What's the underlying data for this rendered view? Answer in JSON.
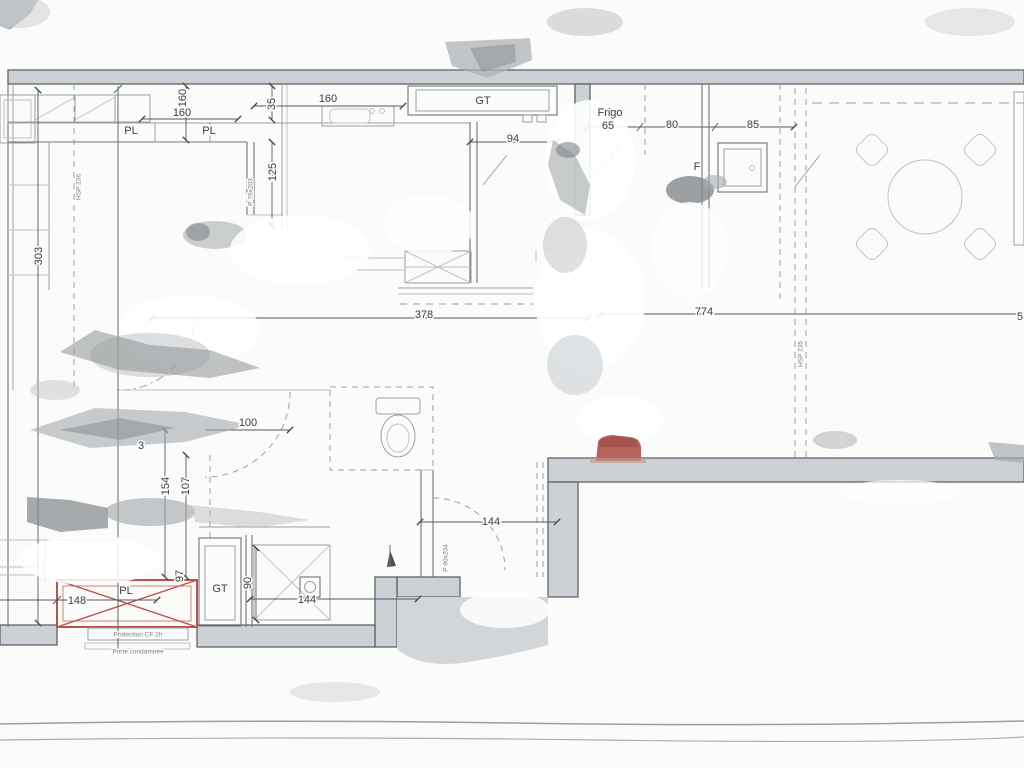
{
  "document": {
    "kind": "scanned architectural floor plan"
  },
  "colors": {
    "paper": "#fbfbfa",
    "wall_fill": "#ccd1d5",
    "line_dark": "#5f6468",
    "line_mid": "#9aa0a5",
    "dim_text": "#3a3e44",
    "red_accent": "#b9544c",
    "red_marker": "#a9554c"
  },
  "labels": {
    "kitchen": {
      "dim_depth": "160",
      "dim_width": "160",
      "pl_left": "PL",
      "pl_right": "PL",
      "dim_35": "35",
      "dim_125": "125",
      "dim_sink": "160",
      "duct": "GT",
      "dim_94": "94",
      "dim_303": "303",
      "hsp": "HSP 236",
      "door": "P 76x203"
    },
    "dining": {
      "fridge": "Frigo",
      "dim_65": "65",
      "dim_80": "80",
      "dim_85": "85",
      "appliance": "F",
      "dim_774": "774",
      "edge_digit": "5",
      "hsp": "HSP 235"
    },
    "hall": {
      "dim_378": "378",
      "door_dim": "100",
      "stray_digit": "3"
    },
    "bath": {
      "dim_154": "154",
      "dim_107": "107",
      "dim_97": "97",
      "dim_90": "90",
      "duct": "GT",
      "dim_inner": "144",
      "door_dim": "144",
      "door": "P 90x204"
    },
    "entry": {
      "dim_148": "148",
      "pl": "PL",
      "note_protection": "Protection CF 2h",
      "note_porte": "Porte condamnée"
    }
  }
}
